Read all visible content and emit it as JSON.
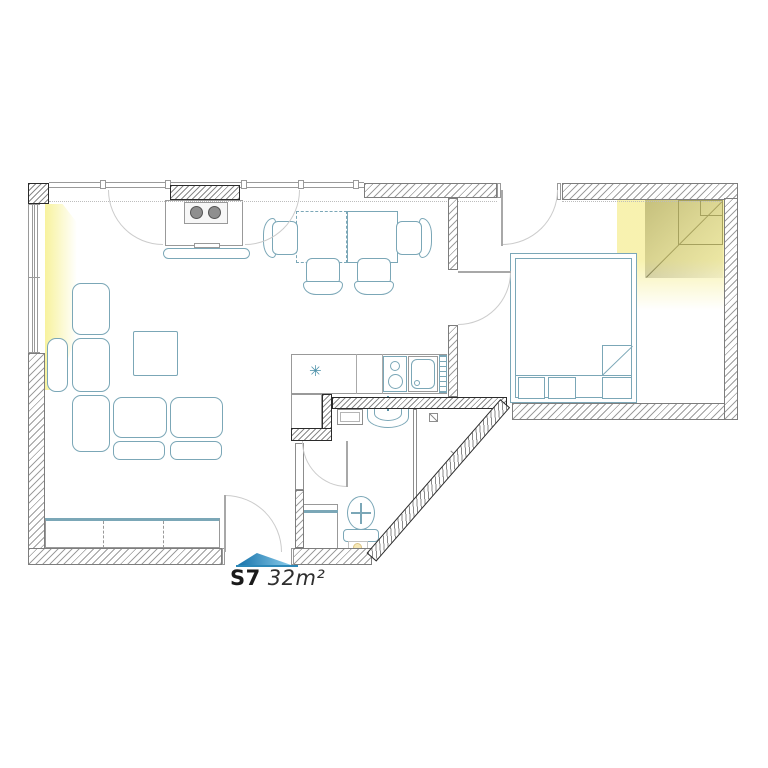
{
  "label": {
    "unit": "S7",
    "area": "32m²"
  },
  "icons": {
    "snowflake_glyph": "✳",
    "entrance_arrow": "triangle-up",
    "fridge_icon": "snowflake",
    "vent_icon": "vent-square"
  },
  "colors": {
    "furniture_teal": "#7ba7b7",
    "wall_hatch_gray": "#9e9e9e",
    "dark_wall_edge": "#2b2b2b",
    "window_light_yellow": "#f2e86e",
    "corner_shadow_gray": "#9a9a9a",
    "entrance_arrow_blue_dark": "#1470a8",
    "entrance_arrow_blue_light": "#8fd0ee",
    "label_text": "#1a1a1a"
  }
}
